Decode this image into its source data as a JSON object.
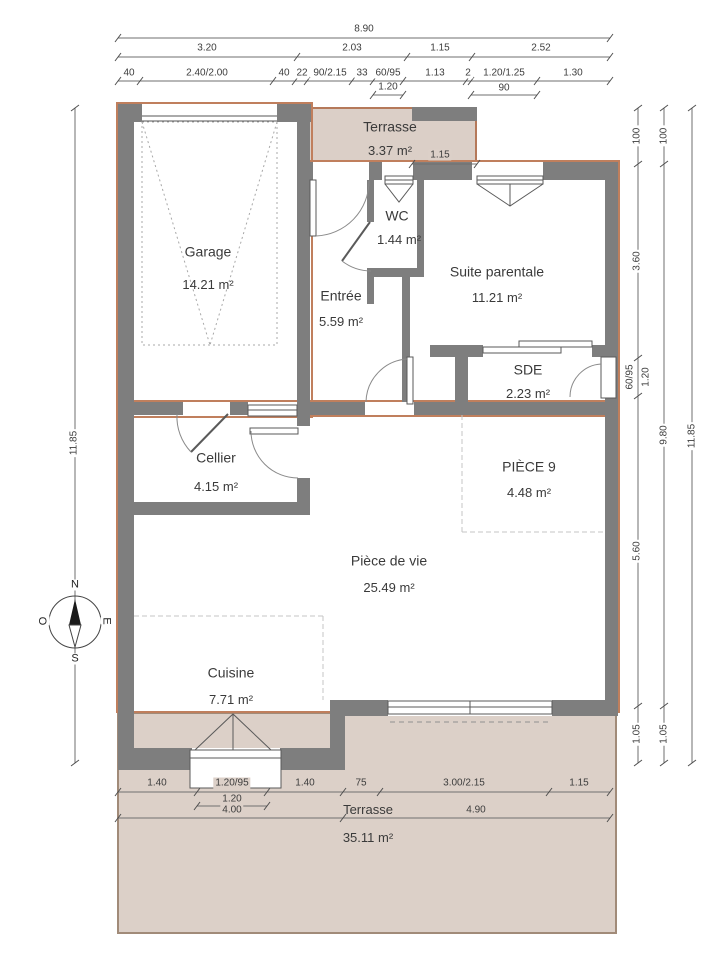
{
  "type": "floor-plan",
  "compass": {
    "n": "N",
    "e": "E",
    "s": "S",
    "o": "O"
  },
  "rooms": {
    "garage": {
      "name": "Garage",
      "area": "14.21 m²"
    },
    "terrasse_nord": {
      "name": "Terrasse",
      "area": "3.37 m²"
    },
    "wc": {
      "name": "WC",
      "area": "1.44 m²"
    },
    "suite_parentale": {
      "name": "Suite parentale",
      "area": "11.21 m²"
    },
    "entree": {
      "name": "Entrée",
      "area": "5.59 m²"
    },
    "sde": {
      "name": "SDE",
      "area": "2.23 m²"
    },
    "cellier": {
      "name": "Cellier",
      "area": "4.15 m²"
    },
    "piece_9": {
      "name": "PIÈCE 9",
      "area": "4.48 m²"
    },
    "piece_de_vie": {
      "name": "Pièce de vie",
      "area": "25.49 m²"
    },
    "cuisine": {
      "name": "Cuisine",
      "area": "7.71 m²"
    },
    "terrasse_sud": {
      "name": "Terrasse",
      "area": "35.11 m²"
    }
  },
  "dims": {
    "top": {
      "total": "8.90",
      "row2": [
        "3.20",
        "2.03",
        "1.15",
        "2.52"
      ],
      "row3": [
        "40",
        "2.40/2.00",
        "40",
        "22",
        "90/2.15",
        "33",
        "60/95",
        "1.13",
        "2",
        "1.20/1.25",
        "1.30"
      ],
      "row4": [
        "1.20",
        "90"
      ],
      "terrasse_width": "1.15"
    },
    "bottom": {
      "row1": [
        "1.40",
        "1.20/95",
        "1.40",
        "75",
        "3.00/2.15",
        "1.15"
      ],
      "row2": "1.20",
      "row3": [
        "4.00",
        "4.90"
      ]
    },
    "right": {
      "col1": [
        "100",
        "3.60",
        "60/95",
        "1.20",
        "5.60",
        "1.05"
      ],
      "col2": [
        "100",
        "9.80",
        "1.05"
      ],
      "col3": "11.85"
    },
    "left": {
      "total": "11.85"
    }
  },
  "colors": {
    "wall": "#7e7e7e",
    "terrace_fill": "#dbcfc7",
    "terrace_border": "#b5795a",
    "envelope_outline": "#c07f5d"
  }
}
